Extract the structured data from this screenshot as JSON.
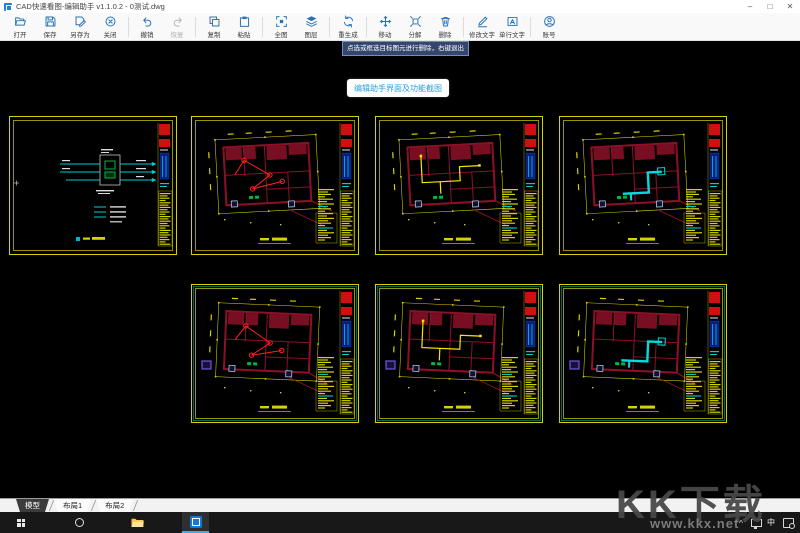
{
  "window": {
    "title": "CAD快速看图-编辑助手 v1.1.0.2 - 0测试.dwg",
    "minimize": "–",
    "maximize": "□",
    "close": "✕"
  },
  "toolbar": {
    "groups": [
      [
        {
          "name": "open",
          "icon": "open",
          "label": "打开"
        },
        {
          "name": "save",
          "icon": "save",
          "label": "保存"
        },
        {
          "name": "save-as",
          "icon": "save-as",
          "label": "另存为"
        },
        {
          "name": "close",
          "icon": "close",
          "label": "关闭"
        }
      ],
      [
        {
          "name": "undo",
          "icon": "undo",
          "label": "撤销"
        },
        {
          "name": "redo",
          "icon": "redo",
          "label": "恢复",
          "disabled": true
        }
      ],
      [
        {
          "name": "copy",
          "icon": "copy",
          "label": "复制"
        },
        {
          "name": "paste",
          "icon": "paste",
          "label": "粘贴"
        }
      ],
      [
        {
          "name": "fit-view",
          "icon": "full",
          "label": "全图"
        },
        {
          "name": "layers",
          "icon": "layers",
          "label": "图层"
        }
      ],
      [
        {
          "name": "regenerate",
          "icon": "regen",
          "label": "重生成"
        }
      ],
      [
        {
          "name": "move",
          "icon": "move",
          "label": "移动"
        },
        {
          "name": "explode",
          "icon": "explode",
          "label": "分解"
        },
        {
          "name": "delete",
          "icon": "delete",
          "label": "删除"
        }
      ],
      [
        {
          "name": "edit-text",
          "icon": "edit-text",
          "label": "修改文字"
        },
        {
          "name": "single-line-text",
          "icon": "single-text",
          "label": "单行文字"
        }
      ],
      [
        {
          "name": "account",
          "icon": "account",
          "label": "账号"
        }
      ]
    ]
  },
  "canvas": {
    "tooltip": "点选或框选目标图元进行删除，右键退出",
    "caption": "编辑助手界面及功能截图"
  },
  "drawings": {
    "items": [
      {
        "name": "drawing-1",
        "variant": "schematic",
        "row": 0,
        "col": 0,
        "accent": "#00cccc"
      },
      {
        "name": "drawing-2",
        "variant": "plan",
        "row": 0,
        "col": 1,
        "accent": "#ff2222",
        "tilt": -3
      },
      {
        "name": "drawing-3",
        "variant": "plan",
        "row": 0,
        "col": 2,
        "accent": "#ffe400",
        "tilt": -3
      },
      {
        "name": "drawing-4",
        "variant": "plan",
        "row": 0,
        "col": 3,
        "accent": "#00dcdc",
        "tilt": -3
      },
      {
        "name": "drawing-5",
        "variant": "plan",
        "row": 1,
        "col": 1,
        "accent": "#ff2222",
        "tilt": 2.5,
        "inner_frame": "#00a8a8"
      },
      {
        "name": "drawing-6",
        "variant": "plan",
        "row": 1,
        "col": 2,
        "accent": "#ffe400",
        "tilt": 2.5,
        "inner_frame": "#00a8a8"
      },
      {
        "name": "drawing-7",
        "variant": "plan",
        "row": 1,
        "col": 3,
        "accent": "#00dcdc",
        "tilt": 2.5,
        "inner_frame": "#00a8a8"
      }
    ]
  },
  "tabs": [
    {
      "name": "model",
      "label": "模型",
      "active": true
    },
    {
      "name": "layout1",
      "label": "布局1",
      "active": false
    },
    {
      "name": "layout2",
      "label": "布局2",
      "active": false
    }
  ],
  "taskbar": {
    "ime": "中"
  },
  "watermark": {
    "title": "KK下载",
    "url": "www.kkx.net"
  },
  "colors": {
    "accent_blue": "#2a72b8",
    "frame_yellow": "#d6d200",
    "wall_maroon": "#8e1028",
    "title_red": "#d01010",
    "cyan": "#00cccc",
    "green": "#00b840"
  }
}
